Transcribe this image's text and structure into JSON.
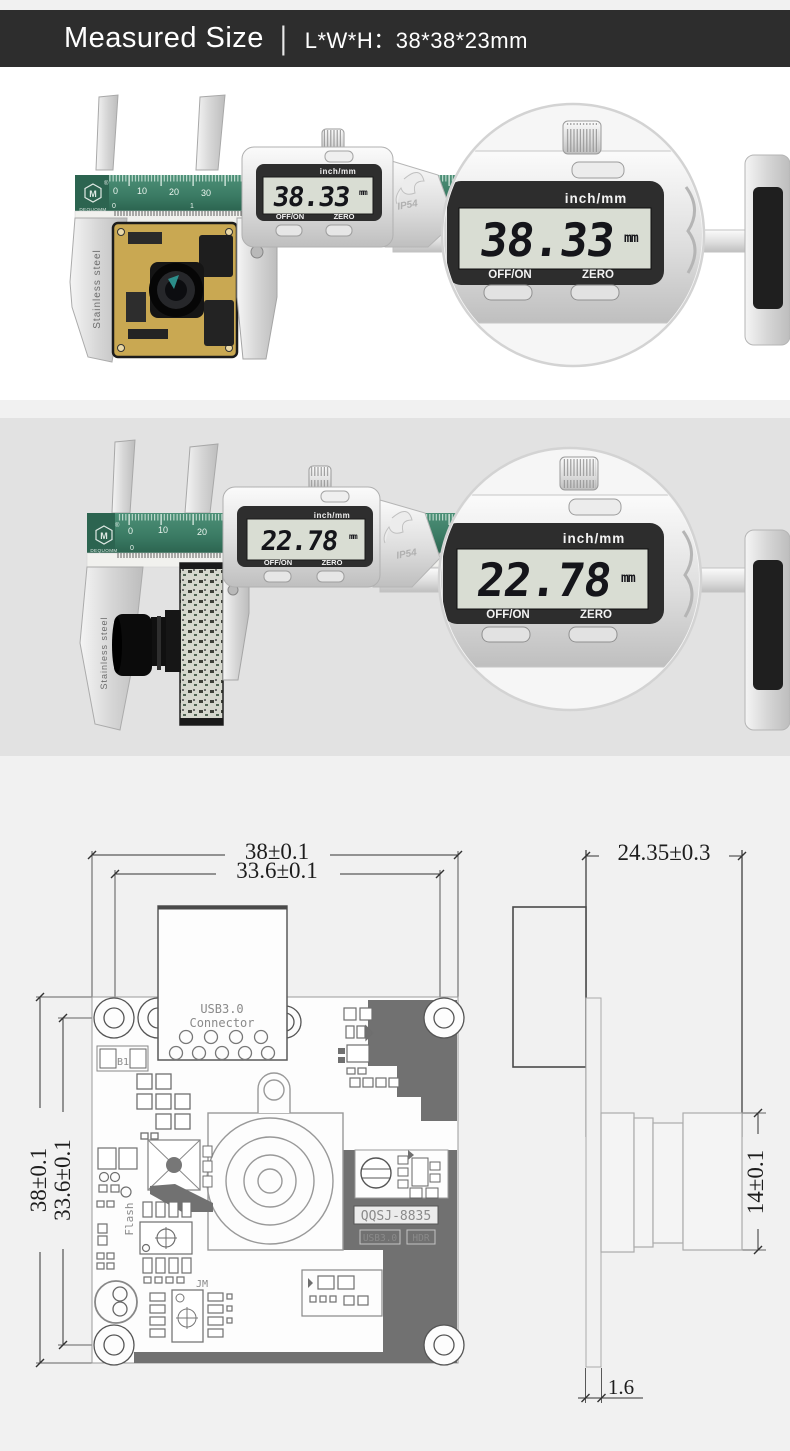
{
  "header": {
    "title": "Measured Size",
    "divider": "|",
    "size_spec": "L*W*H：38*38*23mm"
  },
  "caliper": {
    "mode_label": "inch/mm",
    "off_label": "OFF/ON",
    "zero_label": "ZERO",
    "unit": "mm",
    "ip_rating": "IP54",
    "brand": "DEQUOMM",
    "logo_letter": "M",
    "registered": "®",
    "jaw_text": "Stainless steel"
  },
  "photo1": {
    "reading": "38.33",
    "ruler": [
      "0",
      "10",
      "20",
      "30"
    ],
    "inch_row": [
      "0",
      "1"
    ]
  },
  "photo2": {
    "reading": "22.78",
    "ruler": [
      "0",
      "10",
      "20"
    ],
    "inch_row": [
      "0"
    ]
  },
  "drawing": {
    "front": {
      "dim_width": "38±0.1",
      "dim_width_inner": "33.6±0.1",
      "dim_height": "38±0.1",
      "dim_height_inner": "33.6±0.1",
      "connector_line1": "USB3.0",
      "connector_line2": "Connector",
      "b1_label": "B1",
      "flash_label": "Flash",
      "jm_label": "JM",
      "model_label": "QQSJ-8835",
      "tag_usb": "USB3.0",
      "tag_hdr": "HDR"
    },
    "side": {
      "dim_depth": "24.35±0.3",
      "dim_lens_height": "14±0.1",
      "dim_board_thickness": "1.6"
    }
  },
  "colors": {
    "header_bg": "#2d2d2d",
    "page_bg": "#f1f1f1",
    "section2_bg": "#e2e2e2",
    "ruler_green": "#3a7a63",
    "pcb_gold": "#c9a852",
    "copper_gray": "#717171",
    "lcd_bg": "#d9ddd3"
  }
}
